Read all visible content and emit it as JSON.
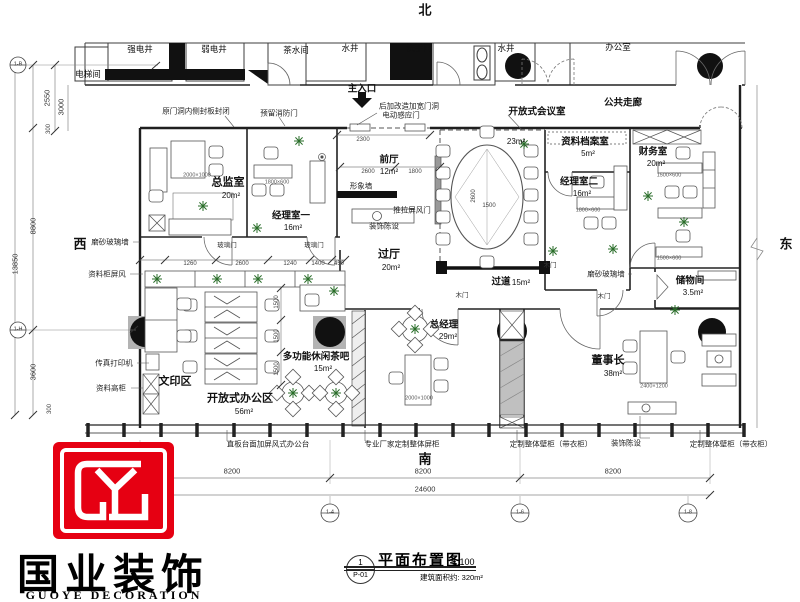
{
  "colors": {
    "brand_red": "#e60012",
    "wall": "#222222",
    "dim": "#555555"
  },
  "title_block": {
    "sheet_no": "1",
    "sheet_code": "P-01",
    "title": "平面布置图",
    "scale": "1:100",
    "area_note": "建筑面积约: 320m²"
  },
  "logo": {
    "cn": "国业装饰",
    "en": "GUOYE DECORATION"
  },
  "plan_labels": [
    {
      "t": "北",
      "x": 425,
      "y": 10,
      "c": "compass",
      "n": "compass-north"
    },
    {
      "t": "西",
      "x": 80,
      "y": 244,
      "c": "compass",
      "n": "compass-west"
    },
    {
      "t": "东",
      "x": 786,
      "y": 244,
      "c": "compass",
      "n": "compass-east"
    },
    {
      "t": "南",
      "x": 425,
      "y": 459,
      "c": "compass",
      "n": "compass-south"
    },
    {
      "t": "电梯间",
      "x": 88,
      "y": 74,
      "c": "room9"
    },
    {
      "t": "强电井",
      "x": 140,
      "y": 49,
      "c": "room9"
    },
    {
      "t": "弱电井",
      "x": 214,
      "y": 49,
      "c": "room9"
    },
    {
      "t": "茶水间",
      "x": 296,
      "y": 50,
      "c": "room9"
    },
    {
      "t": "水井",
      "x": 350,
      "y": 48,
      "c": "room9"
    },
    {
      "t": "洗手间",
      "x": 419,
      "y": 48,
      "c": "room9"
    },
    {
      "t": "水井",
      "x": 506,
      "y": 48,
      "c": "room9"
    },
    {
      "t": "办公室",
      "x": 618,
      "y": 47,
      "c": "room9"
    },
    {
      "t": "公共走廊",
      "x": 623,
      "y": 103,
      "c": "room10"
    },
    {
      "t": "原门洞内侧封板封闭",
      "x": 196,
      "y": 111,
      "c": "note"
    },
    {
      "t": "预留消防门",
      "x": 279,
      "y": 113,
      "c": "note"
    },
    {
      "t": "主入口",
      "x": 362,
      "y": 89,
      "c": "room10"
    },
    {
      "t": "后加改造加宽门洞",
      "x": 409,
      "y": 106,
      "c": "note"
    },
    {
      "t": "电动感应门",
      "x": 401,
      "y": 115,
      "c": "note"
    },
    {
      "t": "开放式会议室",
      "x": 537,
      "y": 112,
      "c": "room10"
    },
    {
      "t": "23m²",
      "x": 516,
      "y": 142,
      "c": "area"
    },
    {
      "t": "总监室",
      "x": 228,
      "y": 183,
      "c": "room"
    },
    {
      "t": "20m²",
      "x": 231,
      "y": 196,
      "c": "area"
    },
    {
      "t": "经理室一",
      "x": 291,
      "y": 216,
      "c": "room10"
    },
    {
      "t": "16m²",
      "x": 293,
      "y": 228,
      "c": "area"
    },
    {
      "t": "前厅",
      "x": 389,
      "y": 160,
      "c": "room10"
    },
    {
      "t": "12m²",
      "x": 389,
      "y": 172,
      "c": "area"
    },
    {
      "t": "形象墙",
      "x": 361,
      "y": 186,
      "c": "note"
    },
    {
      "t": "装饰陈设",
      "x": 384,
      "y": 226,
      "c": "note"
    },
    {
      "t": "推拉屏风门",
      "x": 412,
      "y": 210,
      "c": "note"
    },
    {
      "t": "过厅",
      "x": 389,
      "y": 255,
      "c": "room"
    },
    {
      "t": "20m²",
      "x": 391,
      "y": 268,
      "c": "area"
    },
    {
      "t": "资料档案室",
      "x": 585,
      "y": 142,
      "c": "room10"
    },
    {
      "t": "5m²",
      "x": 588,
      "y": 154,
      "c": "area"
    },
    {
      "t": "经理室二",
      "x": 579,
      "y": 182,
      "c": "room10"
    },
    {
      "t": "16m²",
      "x": 582,
      "y": 194,
      "c": "area"
    },
    {
      "t": "财务室",
      "x": 653,
      "y": 152,
      "c": "room10"
    },
    {
      "t": "20m²",
      "x": 656,
      "y": 164,
      "c": "area"
    },
    {
      "t": "储物间",
      "x": 690,
      "y": 281,
      "c": "room10"
    },
    {
      "t": "3.5m²",
      "x": 693,
      "y": 293,
      "c": "area"
    },
    {
      "t": "磨砂玻璃墙",
      "x": 606,
      "y": 274,
      "c": "note"
    },
    {
      "t": "过道",
      "x": 501,
      "y": 282,
      "c": "room10"
    },
    {
      "t": "15m²",
      "x": 521,
      "y": 283,
      "c": "area"
    },
    {
      "t": "总经理",
      "x": 444,
      "y": 325,
      "c": "room10"
    },
    {
      "t": "29m²",
      "x": 448,
      "y": 337,
      "c": "area"
    },
    {
      "t": "董事长",
      "x": 608,
      "y": 361,
      "c": "room"
    },
    {
      "t": "38m²",
      "x": 613,
      "y": 374,
      "c": "area"
    },
    {
      "t": "多功能休闲茶吧",
      "x": 316,
      "y": 357,
      "c": "room10"
    },
    {
      "t": "15m²",
      "x": 323,
      "y": 369,
      "c": "area"
    },
    {
      "t": "开放式办公区",
      "x": 240,
      "y": 399,
      "c": "room"
    },
    {
      "t": "56m²",
      "x": 244,
      "y": 412,
      "c": "area"
    },
    {
      "t": "文印区",
      "x": 175,
      "y": 382,
      "c": "room"
    },
    {
      "t": "磨砂玻璃墙",
      "x": 110,
      "y": 242,
      "c": "note"
    },
    {
      "t": "资料柜屏风",
      "x": 107,
      "y": 274,
      "c": "note"
    },
    {
      "t": "传真打印机",
      "x": 114,
      "y": 363,
      "c": "note"
    },
    {
      "t": "资料高柜",
      "x": 111,
      "y": 388,
      "c": "note"
    },
    {
      "t": "玻璃门",
      "x": 227,
      "y": 246,
      "c": "door"
    },
    {
      "t": "玻璃门",
      "x": 314,
      "y": 246,
      "c": "door"
    },
    {
      "t": "木门",
      "x": 462,
      "y": 296,
      "c": "door"
    },
    {
      "t": "木门",
      "x": 550,
      "y": 266,
      "c": "door"
    },
    {
      "t": "木门",
      "x": 604,
      "y": 297,
      "c": "door"
    },
    {
      "t": "直板台面加屏风式办公台",
      "x": 268,
      "y": 444,
      "c": "note"
    },
    {
      "t": "专业厂家定制整体屏柜",
      "x": 402,
      "y": 444,
      "c": "note"
    },
    {
      "t": "定制整体壁柜（带衣柜）",
      "x": 551,
      "y": 444,
      "c": "note"
    },
    {
      "t": "装饰陈设",
      "x": 626,
      "y": 443,
      "c": "note"
    },
    {
      "t": "定制整体壁柜（带衣柜）",
      "x": 731,
      "y": 444,
      "c": "note"
    },
    {
      "t": "8200",
      "x": 232,
      "y": 471,
      "c": "dim"
    },
    {
      "t": "8200",
      "x": 423,
      "y": 471,
      "c": "dim"
    },
    {
      "t": "8200",
      "x": 613,
      "y": 471,
      "c": "dim"
    },
    {
      "t": "24600",
      "x": 425,
      "y": 489,
      "c": "dim"
    },
    {
      "t": "2300",
      "x": 363,
      "y": 140,
      "c": "tiny"
    },
    {
      "t": "2600",
      "x": 368,
      "y": 172,
      "c": "tiny"
    },
    {
      "t": "1800",
      "x": 415,
      "y": 172,
      "c": "tiny"
    },
    {
      "t": "1260",
      "x": 190,
      "y": 264,
      "c": "tiny"
    },
    {
      "t": "2600",
      "x": 242,
      "y": 264,
      "c": "tiny"
    },
    {
      "t": "1240",
      "x": 290,
      "y": 264,
      "c": "tiny"
    },
    {
      "t": "1400",
      "x": 318,
      "y": 264,
      "c": "tiny"
    },
    {
      "t": "450",
      "x": 339,
      "y": 264,
      "c": "tiny"
    },
    {
      "t": "1500",
      "x": 277,
      "y": 302,
      "c": "tiny",
      "r": -90
    },
    {
      "t": "1500",
      "x": 277,
      "y": 336,
      "c": "tiny",
      "r": -90
    },
    {
      "t": "1500",
      "x": 277,
      "y": 369,
      "c": "tiny",
      "r": -90
    },
    {
      "t": "2600",
      "x": 474,
      "y": 196,
      "c": "tiny",
      "r": -90
    },
    {
      "t": "1500",
      "x": 489,
      "y": 206,
      "c": "tiny"
    },
    {
      "t": "2550",
      "x": 47,
      "y": 98,
      "c": "dim",
      "r": -90
    },
    {
      "t": "3000",
      "x": 61,
      "y": 107,
      "c": "dim",
      "r": -90
    },
    {
      "t": "300",
      "x": 49,
      "y": 129,
      "c": "tiny",
      "r": -90
    },
    {
      "t": "8800",
      "x": 33,
      "y": 226,
      "c": "dim",
      "r": -90
    },
    {
      "t": "13850",
      "x": 15,
      "y": 264,
      "c": "dim",
      "r": -90
    },
    {
      "t": "3600",
      "x": 33,
      "y": 372,
      "c": "dim",
      "r": -90
    },
    {
      "t": "300",
      "x": 50,
      "y": 409,
      "c": "tiny",
      "r": -90
    },
    {
      "t": "2000×1000",
      "x": 197,
      "y": 176,
      "c": "fdim"
    },
    {
      "t": "1800×600",
      "x": 277,
      "y": 183,
      "c": "fdim"
    },
    {
      "t": "1800×600",
      "x": 588,
      "y": 211,
      "c": "fdim"
    },
    {
      "t": "1500×600",
      "x": 669,
      "y": 176,
      "c": "fdim"
    },
    {
      "t": "1500×600",
      "x": 669,
      "y": 259,
      "c": "fdim"
    },
    {
      "t": "2000×1000",
      "x": 419,
      "y": 399,
      "c": "fdim"
    },
    {
      "t": "2400×1200",
      "x": 654,
      "y": 387,
      "c": "fdim"
    },
    {
      "t": "1-B",
      "x": 18,
      "y": 65,
      "c": "axis"
    },
    {
      "t": "1-H",
      "x": 18,
      "y": 330,
      "c": "axis"
    },
    {
      "t": "1-4",
      "x": 330,
      "y": 513,
      "c": "axis"
    },
    {
      "t": "1-6",
      "x": 520,
      "y": 513,
      "c": "axis"
    },
    {
      "t": "1-8",
      "x": 688,
      "y": 513,
      "c": "axis"
    }
  ]
}
